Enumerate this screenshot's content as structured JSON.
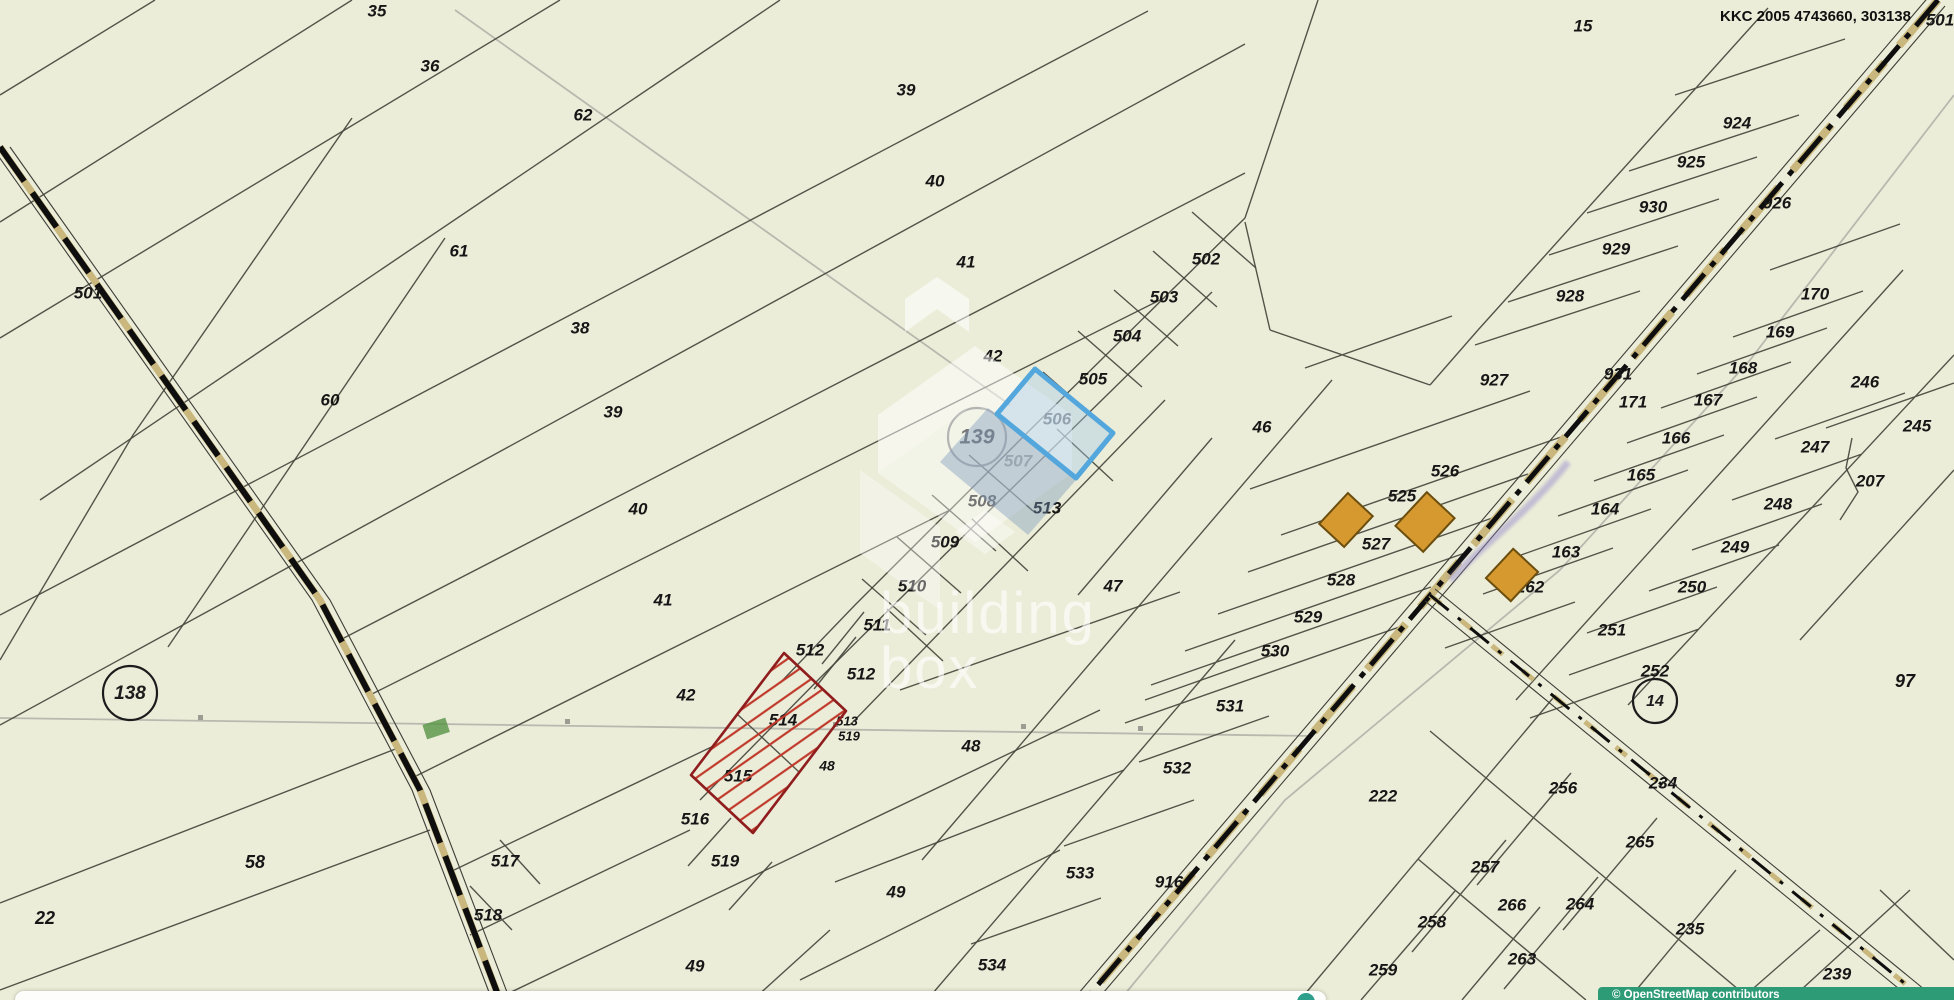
{
  "map": {
    "corner_code": "KKC 2005 4743660, 303138",
    "background": "#ecedd9",
    "colors": {
      "parcel_line": "#45453c",
      "label": "#161616",
      "road_dash": "#0e0e0e",
      "road_tan": "#c9b77d",
      "osm_underlay_gray": "#b2b2a8",
      "highlight_red_border": "#8f1d1d",
      "highlight_red_hatch": "#c03a2b",
      "highlight_blue_border": "#53a7dc",
      "highlight_blue_fill": "rgba(160,200,235,0.38)",
      "building_fill": "#d6992f",
      "building_stroke": "#6b4e0e",
      "attribution_bg": "#2e9b77",
      "street_script_purple": "#8f83cc",
      "green_patch": "#569243"
    },
    "labels": [
      {
        "t": "35",
        "x": 377,
        "y": 12
      },
      {
        "t": "36",
        "x": 430,
        "y": 67
      },
      {
        "t": "62",
        "x": 583,
        "y": 116
      },
      {
        "t": "39",
        "x": 906,
        "y": 91
      },
      {
        "t": "40",
        "x": 935,
        "y": 182
      },
      {
        "t": "61",
        "x": 459,
        "y": 252
      },
      {
        "t": "41",
        "x": 966,
        "y": 263
      },
      {
        "t": "38",
        "x": 580,
        "y": 329
      },
      {
        "t": "42",
        "x": 993,
        "y": 357
      },
      {
        "t": "60",
        "x": 330,
        "y": 401
      },
      {
        "t": "39",
        "x": 613,
        "y": 413
      },
      {
        "t": "40",
        "x": 638,
        "y": 510
      },
      {
        "t": "41",
        "x": 663,
        "y": 601
      },
      {
        "t": "42",
        "x": 686,
        "y": 696
      },
      {
        "t": "502",
        "x": 1206,
        "y": 260
      },
      {
        "t": "503",
        "x": 1164,
        "y": 298
      },
      {
        "t": "504",
        "x": 1127,
        "y": 337
      },
      {
        "t": "505",
        "x": 1093,
        "y": 380
      },
      {
        "t": "506",
        "x": 1057,
        "y": 420
      },
      {
        "t": "507",
        "x": 1018,
        "y": 462,
        "washed": true
      },
      {
        "t": "508",
        "x": 982,
        "y": 502
      },
      {
        "t": "509",
        "x": 945,
        "y": 543
      },
      {
        "t": "510",
        "x": 912,
        "y": 587
      },
      {
        "t": "511",
        "x": 877,
        "y": 626
      },
      {
        "t": "512",
        "x": 810,
        "y": 651
      },
      {
        "t": "512",
        "x": 861,
        "y": 675
      },
      {
        "t": "513",
        "x": 1047,
        "y": 509
      },
      {
        "t": "514",
        "x": 783,
        "y": 721
      },
      {
        "t": "515",
        "x": 738,
        "y": 777
      },
      {
        "t": "516",
        "x": 695,
        "y": 820
      },
      {
        "t": "513",
        "x": 847,
        "y": 722,
        "size": 13
      },
      {
        "t": "519",
        "x": 849,
        "y": 737,
        "size": 13
      },
      {
        "t": "48",
        "x": 827,
        "y": 767,
        "size": 14
      },
      {
        "t": "517",
        "x": 505,
        "y": 862
      },
      {
        "t": "518",
        "x": 488,
        "y": 916
      },
      {
        "t": "519",
        "x": 725,
        "y": 862
      },
      {
        "t": "49",
        "x": 896,
        "y": 893
      },
      {
        "t": "49",
        "x": 695,
        "y": 967
      },
      {
        "t": "534",
        "x": 992,
        "y": 966
      },
      {
        "t": "533",
        "x": 1080,
        "y": 874
      },
      {
        "t": "532",
        "x": 1177,
        "y": 769
      },
      {
        "t": "531",
        "x": 1230,
        "y": 707
      },
      {
        "t": "530",
        "x": 1275,
        "y": 652
      },
      {
        "t": "529",
        "x": 1308,
        "y": 618
      },
      {
        "t": "528",
        "x": 1341,
        "y": 581
      },
      {
        "t": "527",
        "x": 1376,
        "y": 545
      },
      {
        "t": "525",
        "x": 1402,
        "y": 497
      },
      {
        "t": "526",
        "x": 1445,
        "y": 472
      },
      {
        "t": "46",
        "x": 1262,
        "y": 428
      },
      {
        "t": "47",
        "x": 1113,
        "y": 587
      },
      {
        "t": "48",
        "x": 971,
        "y": 747
      },
      {
        "t": "58",
        "x": 255,
        "y": 863,
        "size": 18
      },
      {
        "t": "22",
        "x": 45,
        "y": 919,
        "size": 18
      },
      {
        "t": "916",
        "x": 1169,
        "y": 883
      },
      {
        "t": "926",
        "x": 1777,
        "y": 204
      },
      {
        "t": "931",
        "x": 1618,
        "y": 375
      },
      {
        "t": "171",
        "x": 1633,
        "y": 403
      },
      {
        "t": "927",
        "x": 1494,
        "y": 381
      },
      {
        "t": "924",
        "x": 1737,
        "y": 124
      },
      {
        "t": "925",
        "x": 1691,
        "y": 163
      },
      {
        "t": "930",
        "x": 1653,
        "y": 208
      },
      {
        "t": "929",
        "x": 1616,
        "y": 250
      },
      {
        "t": "928",
        "x": 1570,
        "y": 297
      },
      {
        "t": "15",
        "x": 1583,
        "y": 27
      },
      {
        "t": "170",
        "x": 1815,
        "y": 295
      },
      {
        "t": "169",
        "x": 1780,
        "y": 333
      },
      {
        "t": "168",
        "x": 1743,
        "y": 369
      },
      {
        "t": "167",
        "x": 1708,
        "y": 401
      },
      {
        "t": "166",
        "x": 1676,
        "y": 439
      },
      {
        "t": "165",
        "x": 1641,
        "y": 476
      },
      {
        "t": "164",
        "x": 1605,
        "y": 510
      },
      {
        "t": "163",
        "x": 1566,
        "y": 553
      },
      {
        "t": "162",
        "x": 1530,
        "y": 588
      },
      {
        "t": "246",
        "x": 1865,
        "y": 383
      },
      {
        "t": "245",
        "x": 1917,
        "y": 427
      },
      {
        "t": "247",
        "x": 1815,
        "y": 448
      },
      {
        "t": "207",
        "x": 1870,
        "y": 482
      },
      {
        "t": "248",
        "x": 1778,
        "y": 505
      },
      {
        "t": "249",
        "x": 1735,
        "y": 548
      },
      {
        "t": "250",
        "x": 1692,
        "y": 588
      },
      {
        "t": "251",
        "x": 1612,
        "y": 631
      },
      {
        "t": "252",
        "x": 1655,
        "y": 672
      },
      {
        "t": "97",
        "x": 1905,
        "y": 682,
        "size": 18
      },
      {
        "t": "222",
        "x": 1383,
        "y": 797
      },
      {
        "t": "256",
        "x": 1563,
        "y": 789
      },
      {
        "t": "234",
        "x": 1663,
        "y": 784
      },
      {
        "t": "257",
        "x": 1485,
        "y": 868
      },
      {
        "t": "265",
        "x": 1640,
        "y": 843
      },
      {
        "t": "266",
        "x": 1512,
        "y": 906
      },
      {
        "t": "264",
        "x": 1580,
        "y": 905
      },
      {
        "t": "258",
        "x": 1432,
        "y": 923
      },
      {
        "t": "235",
        "x": 1690,
        "y": 930
      },
      {
        "t": "259",
        "x": 1383,
        "y": 971
      },
      {
        "t": "263",
        "x": 1522,
        "y": 960
      },
      {
        "t": "239",
        "x": 1837,
        "y": 975
      },
      {
        "t": "501",
        "x": 88,
        "y": 294
      },
      {
        "t": "501",
        "x": 1940,
        "y": 21
      }
    ],
    "circled_labels": [
      {
        "t": "138",
        "x": 130,
        "y": 693,
        "r": 27
      },
      {
        "t": "139",
        "x": 977,
        "y": 437,
        "r": 29,
        "washed": true
      },
      {
        "t": "14",
        "x": 1655,
        "y": 701,
        "r": 22
      }
    ],
    "buildings": [
      {
        "x": 1346,
        "y": 520,
        "w": 42,
        "h": 34,
        "rot": -47
      },
      {
        "x": 1425,
        "y": 522,
        "w": 46,
        "h": 38,
        "rot": -47
      },
      {
        "x": 1512,
        "y": 575,
        "w": 40,
        "h": 34,
        "rot": -47
      }
    ],
    "highlights": {
      "red": {
        "points": "784,653 846,711 753,833 691,775"
      },
      "blue": {
        "points": "1035,369 1113,433 1076,478 997,414"
      },
      "bluewash": {
        "points": "988,408 1076,480 1028,535 940,462"
      }
    }
  },
  "watermark": {
    "line1": "building",
    "line2": "box"
  },
  "attribution": {
    "text": "© OpenStreetMap  contributors"
  }
}
